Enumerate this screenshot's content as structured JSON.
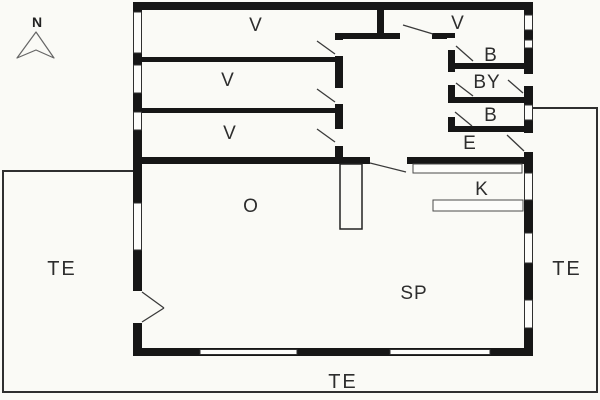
{
  "compass": {
    "north_label": "N"
  },
  "rooms": {
    "v1": "V",
    "v2": "V",
    "v3": "V",
    "v4": "V",
    "b1": "B",
    "by": "BY",
    "b2": "B",
    "entry": "E",
    "kitchen": "K",
    "o_room": "O",
    "sp_room": "SP"
  },
  "terraces": {
    "left": "TE",
    "right": "TE",
    "bottom": "TE"
  },
  "colors": {
    "wall": "#161616",
    "line": "#3a3a3a",
    "background": "#fafaf6"
  }
}
